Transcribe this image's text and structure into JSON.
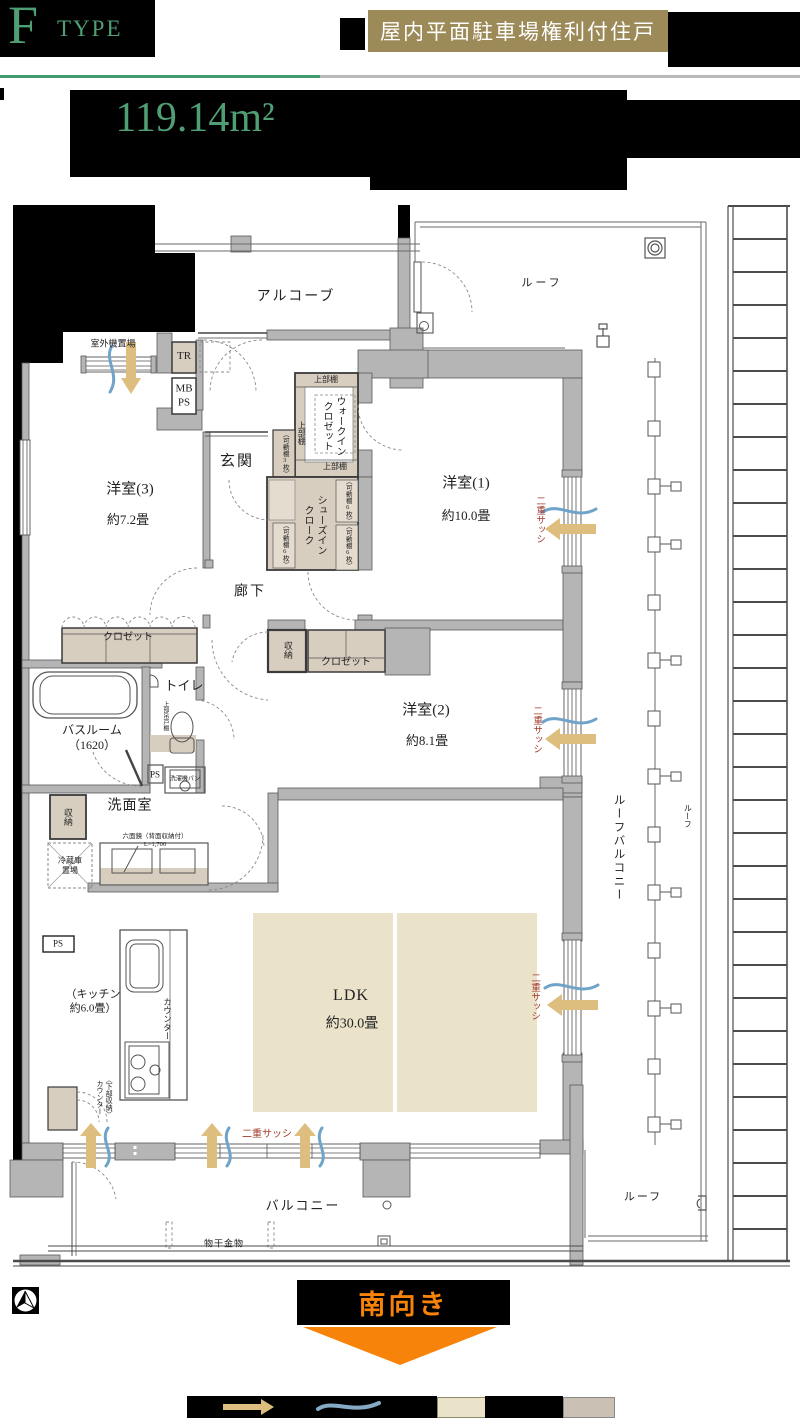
{
  "header": {
    "type_letter": "F",
    "type_word": "TYPE",
    "badge": "屋内平面駐車場権利付住戸",
    "area": "119.14m²"
  },
  "direction": {
    "south": "南向き"
  },
  "plan": {
    "labels": [
      {
        "n": "outdoor-unit-space",
        "t": "室外機置場",
        "x": 113,
        "y": 344,
        "s": 9
      },
      {
        "n": "trunk-room",
        "t": "TR",
        "x": 184,
        "y": 357,
        "s": 11
      },
      {
        "n": "meter-box-pipe-space",
        "t": "MB\nPS",
        "x": 184,
        "y": 396,
        "s": 11
      },
      {
        "n": "alcove",
        "t": "アルコーブ",
        "x": 296,
        "y": 297,
        "s": 14,
        "ls": 2
      },
      {
        "n": "roof-top",
        "t": "ルーフ",
        "x": 542,
        "y": 284,
        "s": 11,
        "ls": 3
      },
      {
        "n": "entrance",
        "t": "玄関",
        "x": 237,
        "y": 462,
        "s": 15,
        "ls": 2
      },
      {
        "n": "upper-shelf-top",
        "t": "上部棚",
        "x": 326,
        "y": 380,
        "s": 8
      },
      {
        "n": "walk-in-closet",
        "t": "ウォークイン\nクロゼット",
        "x": 333,
        "y": 426,
        "s": 10,
        "v": 1
      },
      {
        "n": "upper-shelf-side",
        "t": "上部棚",
        "x": 301,
        "y": 433,
        "s": 8,
        "v": 1
      },
      {
        "n": "movable-shelf-3",
        "t": "（可動棚3枚）",
        "x": 284,
        "y": 454,
        "s": 6.5,
        "v": 1
      },
      {
        "n": "upper-shelf-bottom",
        "t": "上部棚",
        "x": 335,
        "y": 467,
        "s": 8
      },
      {
        "n": "bedroom3",
        "t": "洋室(3)",
        "x": 130,
        "y": 490,
        "s": 15
      },
      {
        "n": "bedroom3-size",
        "t": "約7.2畳",
        "x": 128,
        "y": 520,
        "s": 13
      },
      {
        "n": "bedroom1",
        "t": "洋室(1)",
        "x": 466,
        "y": 484,
        "s": 15
      },
      {
        "n": "bedroom1-size",
        "t": "約10.0畳",
        "x": 466,
        "y": 516,
        "s": 13
      },
      {
        "n": "double-sash-1",
        "t": "二重サッシ",
        "x": 539,
        "y": 520,
        "s": 9.5,
        "v": 1,
        "c": "#a13a2c"
      },
      {
        "n": "shoes-in-cloak",
        "t": "シューズイン\nクローク",
        "x": 314,
        "y": 525,
        "s": 10,
        "v": 1
      },
      {
        "n": "movable-shelf-6a",
        "t": "（可動棚6枚）",
        "x": 347,
        "y": 501,
        "s": 6.5,
        "v": 1
      },
      {
        "n": "movable-shelf-6b",
        "t": "（可動棚6枚）",
        "x": 347,
        "y": 546,
        "s": 6.5,
        "v": 1
      },
      {
        "n": "movable-shelf-6c",
        "t": "（可動棚6枚）",
        "x": 284,
        "y": 545,
        "s": 6.5,
        "v": 1
      },
      {
        "n": "corridor",
        "t": "廊下",
        "x": 250,
        "y": 592,
        "s": 14,
        "ls": 2
      },
      {
        "n": "closet-bedroom3",
        "t": "クロゼット",
        "x": 128,
        "y": 638,
        "s": 10
      },
      {
        "n": "storage-corridor",
        "t": "収納",
        "x": 287,
        "y": 650,
        "s": 9,
        "v": 1
      },
      {
        "n": "closet-bedroom2",
        "t": "クロゼット",
        "x": 346,
        "y": 663,
        "s": 10
      },
      {
        "n": "toilet",
        "t": "トイレ",
        "x": 184,
        "y": 686,
        "s": 13
      },
      {
        "n": "upper-hanging-cabinet",
        "t": "上部吊戸棚",
        "x": 164,
        "y": 716,
        "s": 6,
        "v": 1
      },
      {
        "n": "bathroom",
        "t": "バスルーム\n（1620）",
        "x": 92,
        "y": 738,
        "s": 12
      },
      {
        "n": "bedroom2",
        "t": "洋室(2)",
        "x": 426,
        "y": 711,
        "s": 15
      },
      {
        "n": "bedroom2-size",
        "t": "約8.1畳",
        "x": 427,
        "y": 741,
        "s": 13
      },
      {
        "n": "double-sash-2",
        "t": "二重サッシ",
        "x": 536,
        "y": 730,
        "s": 9.5,
        "v": 1,
        "c": "#a13a2c"
      },
      {
        "n": "pipe-space-1",
        "t": "PS",
        "x": 155,
        "y": 775,
        "s": 9
      },
      {
        "n": "washer-pan",
        "t": "洗濯機パン",
        "x": 185,
        "y": 780,
        "s": 6
      },
      {
        "n": "washroom",
        "t": "洗面室",
        "x": 130,
        "y": 806,
        "s": 14,
        "ls": 1
      },
      {
        "n": "storage-washroom",
        "t": "収納",
        "x": 67,
        "y": 817,
        "s": 9,
        "v": 1
      },
      {
        "n": "six-sided-mirror",
        "t": "六面鏡（背面収納付）\nL=1,700",
        "x": 155,
        "y": 841,
        "s": 6.5
      },
      {
        "n": "fridge-space",
        "t": "冷蔵庫\n置場",
        "x": 70,
        "y": 866,
        "s": 8
      },
      {
        "n": "pipe-space-2",
        "t": "PS",
        "x": 58,
        "y": 944,
        "s": 9
      },
      {
        "n": "kitchen",
        "t": "（キッチン\n約6.0畳）",
        "x": 93,
        "y": 1002,
        "s": 11
      },
      {
        "n": "counter",
        "t": "カウンター",
        "x": 167,
        "y": 1019,
        "s": 8.5,
        "v": 1
      },
      {
        "n": "ldk",
        "t": "LDK",
        "x": 351,
        "y": 996,
        "s": 16,
        "ls": 1
      },
      {
        "n": "ldk-size",
        "t": "約30.0畳",
        "x": 352,
        "y": 1024,
        "s": 14
      },
      {
        "n": "double-sash-3",
        "t": "二重サッシ",
        "x": 534,
        "y": 997,
        "s": 9.5,
        "v": 1,
        "c": "#a13a2c"
      },
      {
        "n": "lower-storage-counter",
        "t": "〈下部収納〉\nカウンター",
        "x": 104,
        "y": 1097,
        "s": 7,
        "v": 1
      },
      {
        "n": "roof-balcony",
        "t": "ルーフバルコニー",
        "x": 618,
        "y": 848,
        "s": 11.5,
        "v": 1,
        "ls": 2
      },
      {
        "n": "roof-right",
        "t": "ルーフ",
        "x": 687,
        "y": 816,
        "s": 8,
        "v": 1
      },
      {
        "n": "double-sash-4",
        "t": "二重サッシ",
        "x": 267,
        "y": 1135,
        "s": 10,
        "c": "#a13a2c"
      },
      {
        "n": "balcony",
        "t": "バルコニー",
        "x": 303,
        "y": 1206,
        "s": 13,
        "ls": 2
      },
      {
        "n": "laundry-hardware",
        "t": "物干金物",
        "x": 224,
        "y": 1244,
        "s": 9,
        "ls": 1
      },
      {
        "n": "roof-bottom",
        "t": "ルーフ",
        "x": 643,
        "y": 1198,
        "s": 11,
        "ls": 2
      }
    ]
  }
}
